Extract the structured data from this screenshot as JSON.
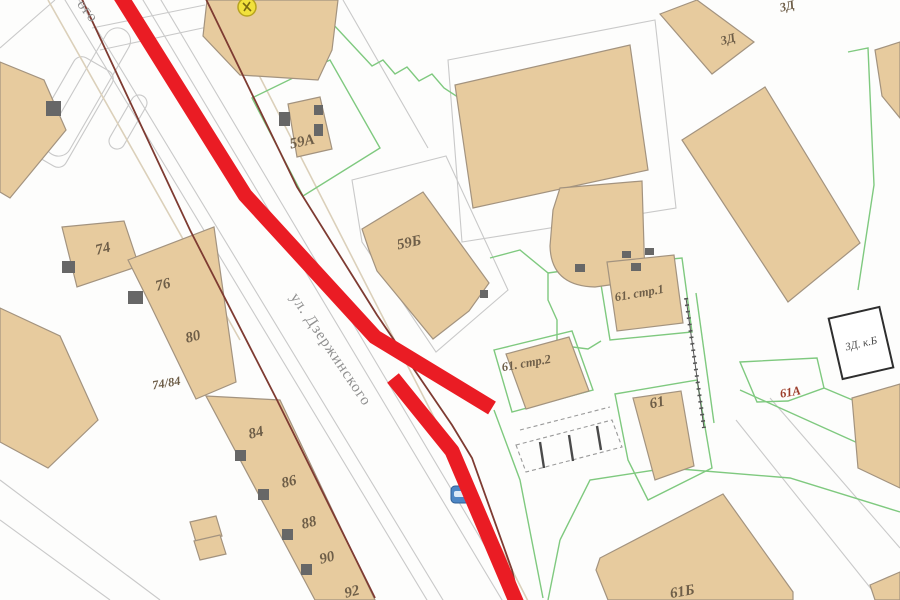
{
  "colors": {
    "background": "#fdfdfc",
    "building_fill": "#e7cb9e",
    "building_stroke": "#a3937f",
    "entrance_fill": "#676767",
    "parcel_green": "#7fc97f",
    "road_gray": "#c9c9c9",
    "road_beige": "#dbd0ba",
    "boundary_maroon": "#7e3b32",
    "route_red": "#ea1c24",
    "label_brown": "#6e5e48",
    "label_red": "#9c3d2a",
    "street_label_gray": "#8f8f8f",
    "marker_yellow": "#f1e13c",
    "marker_yellow_stroke": "#b8a41f",
    "car_blue": "#4d86c4",
    "annotation_border": "#2e2e2e",
    "annotation_text": "#4a4a4a"
  },
  "street": {
    "name": "ул. Дзержинского",
    "name_partial": "ого"
  },
  "building_labels": {
    "b74": "74",
    "b76": "76",
    "b80": "80",
    "b7484": "74/84",
    "b84": "84",
    "b86": "86",
    "b88": "88",
    "b90": "90",
    "b92": "92",
    "b59a": "59А",
    "b59b": "59Б",
    "b61s1": "61. стр.1",
    "b61s2": "61. стр.2",
    "b61": "61",
    "b61b": "61Б",
    "b61a": "61А"
  },
  "area_labels": {
    "zd_top": "3Д",
    "zd_mid": "3Д",
    "zd_annotation": "3Д. к.Б"
  },
  "icons": {
    "car": "car-icon",
    "poi": "poi-marker-icon"
  }
}
